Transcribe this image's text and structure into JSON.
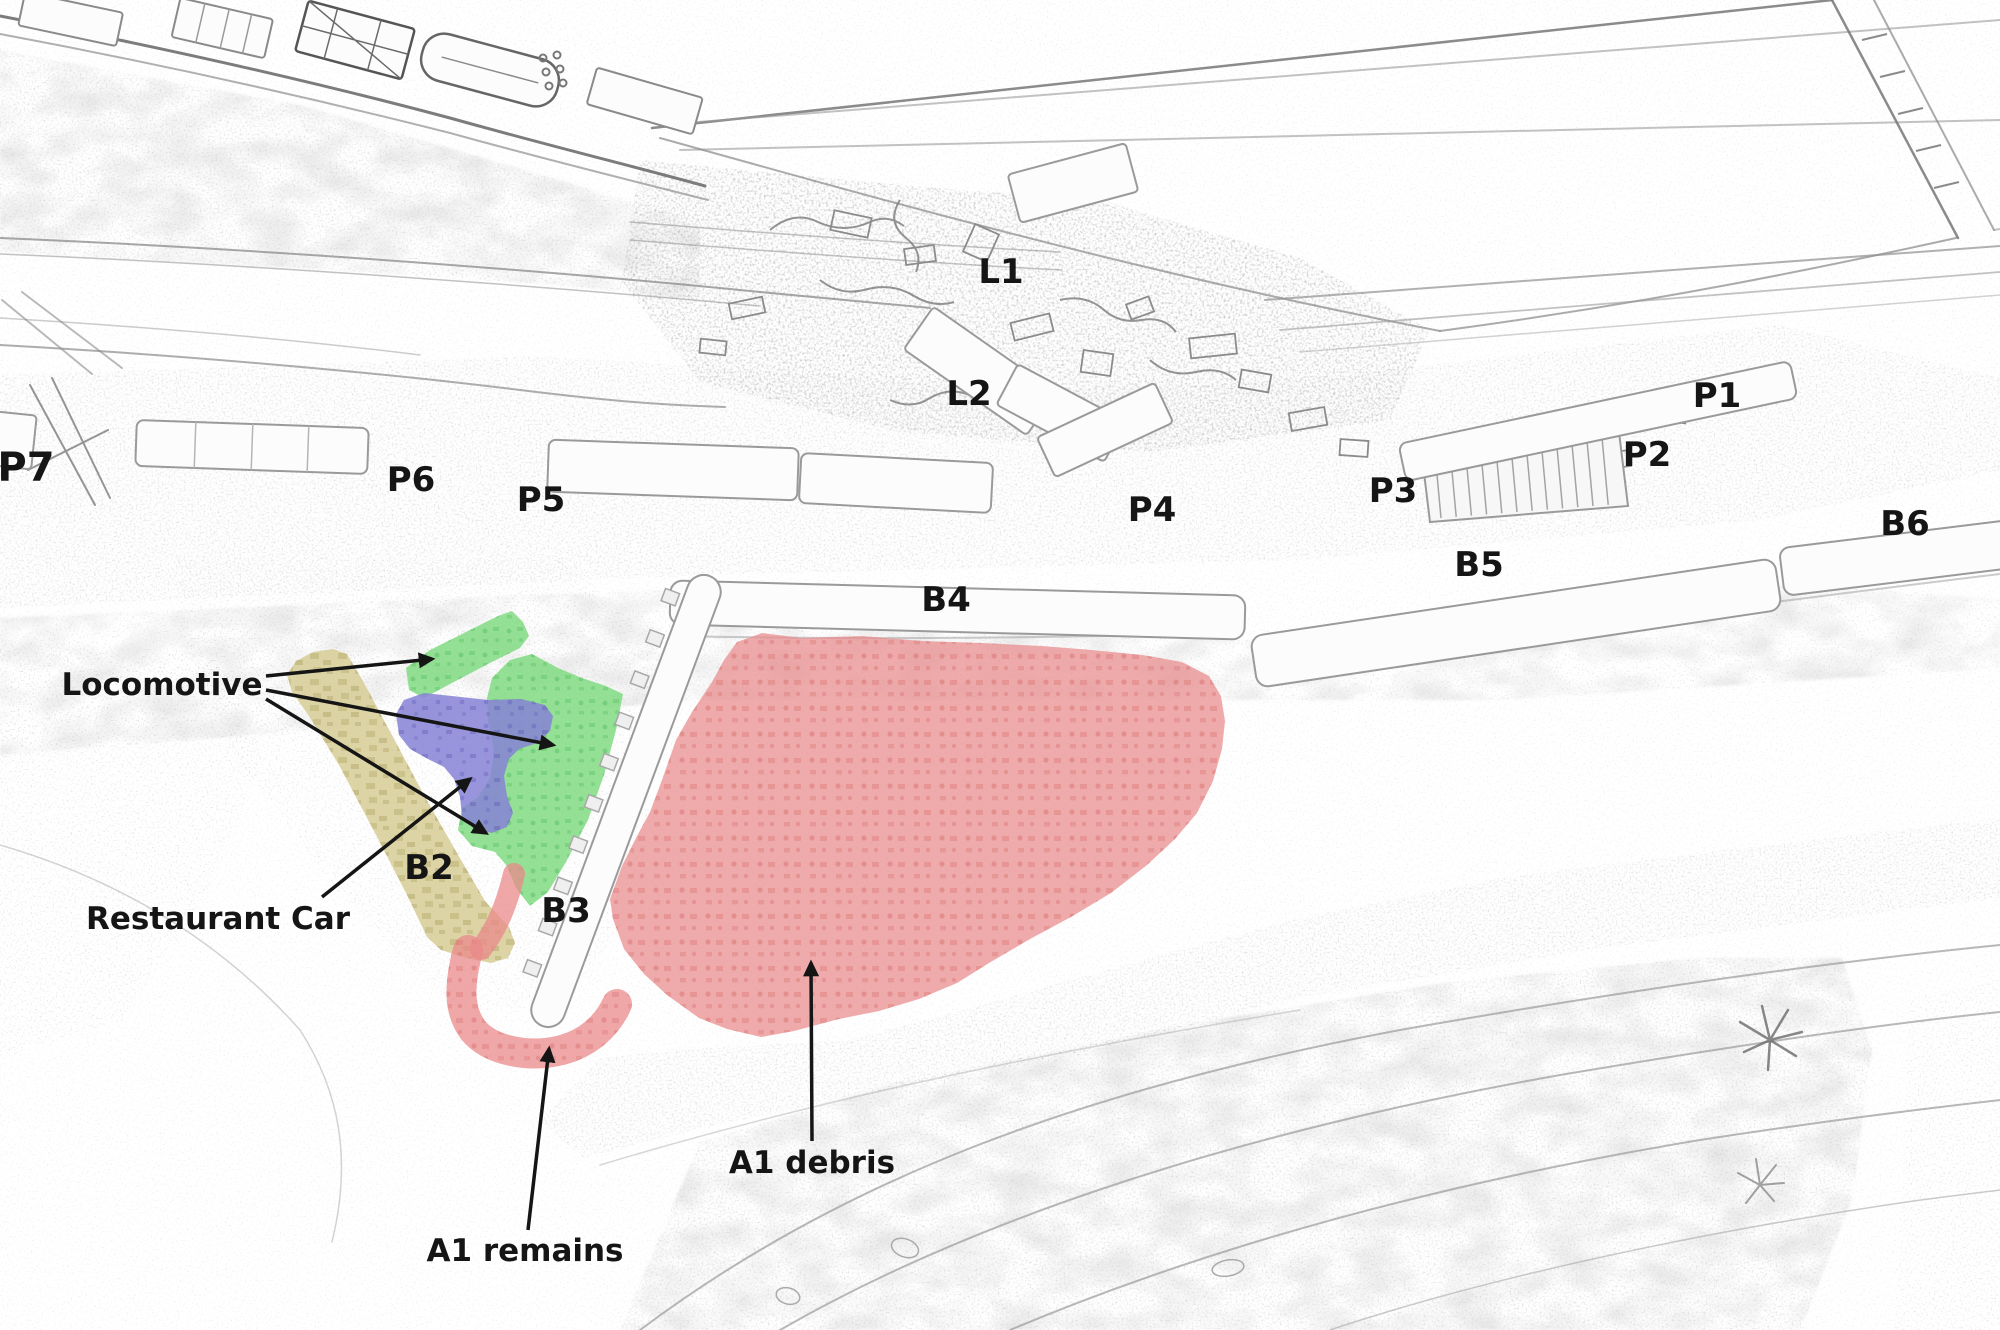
{
  "diagram": {
    "title": "Derailment site sketch map",
    "canvas": {
      "width": 2000,
      "height": 1330
    },
    "colors": {
      "background": "#ffffff",
      "sketch_line": "#8f8f8f",
      "label_text": "#151515",
      "arrow": "#151515",
      "car_fill": "#fcfcfc",
      "locomotive_green": "#79da7c",
      "restaurant_car_blue": "#8783d6",
      "carriage_tan": "#d7cc97",
      "wreck_red": "#e98a8a"
    },
    "car_labels": [
      {
        "id": "P7",
        "text": "P7",
        "x": 26,
        "y": 466,
        "size": 40
      },
      {
        "id": "P6",
        "text": "P6",
        "x": 411,
        "y": 479,
        "size": 34
      },
      {
        "id": "P5",
        "text": "P5",
        "x": 541,
        "y": 499,
        "size": 34
      },
      {
        "id": "L1",
        "text": "L1",
        "x": 1001,
        "y": 271,
        "size": 34
      },
      {
        "id": "L2",
        "text": "L2",
        "x": 969,
        "y": 393,
        "size": 34
      },
      {
        "id": "P4",
        "text": "P4",
        "x": 1152,
        "y": 509,
        "size": 34
      },
      {
        "id": "P3",
        "text": "P3",
        "x": 1393,
        "y": 490,
        "size": 34
      },
      {
        "id": "P2",
        "text": "P2",
        "x": 1647,
        "y": 454,
        "size": 34
      },
      {
        "id": "P1",
        "text": "P1",
        "x": 1717,
        "y": 395,
        "size": 34
      },
      {
        "id": "B6",
        "text": "B6",
        "x": 1905,
        "y": 523,
        "size": 34
      },
      {
        "id": "B5",
        "text": "B5",
        "x": 1479,
        "y": 564,
        "size": 34
      },
      {
        "id": "B4",
        "text": "B4",
        "x": 946,
        "y": 599,
        "size": 34
      },
      {
        "id": "B3",
        "text": "B3",
        "x": 566,
        "y": 910,
        "size": 34
      },
      {
        "id": "B2",
        "text": "B2",
        "x": 429,
        "y": 867,
        "size": 34
      }
    ],
    "annotations": [
      {
        "id": "locomotive",
        "text": "Locomotive",
        "x": 162,
        "y": 684,
        "arrows": [
          {
            "x1": 266,
            "y1": 676,
            "x2": 432,
            "y2": 659
          },
          {
            "x1": 266,
            "y1": 690,
            "x2": 553,
            "y2": 745
          },
          {
            "x1": 266,
            "y1": 699,
            "x2": 486,
            "y2": 833
          }
        ]
      },
      {
        "id": "restaurant-car",
        "text": "Restaurant Car",
        "x": 218,
        "y": 918,
        "arrows": [
          {
            "x1": 322,
            "y1": 897,
            "x2": 470,
            "y2": 779
          }
        ]
      },
      {
        "id": "a1-remains",
        "text": "A1 remains",
        "x": 525,
        "y": 1250,
        "arrows": [
          {
            "x1": 528,
            "y1": 1230,
            "x2": 549,
            "y2": 1049
          }
        ]
      },
      {
        "id": "a1-debris",
        "text": "A1 debris",
        "x": 812,
        "y": 1162,
        "arrows": [
          {
            "x1": 812,
            "y1": 1141,
            "x2": 811,
            "y2": 963
          }
        ]
      }
    ],
    "regions": [
      {
        "id": "locomotive-area",
        "color_key": "locomotive_green",
        "label_ref": "Locomotive"
      },
      {
        "id": "restaurant-car-area",
        "color_key": "restaurant_car_blue",
        "label_ref": "Restaurant Car"
      },
      {
        "id": "carriage-b2-area",
        "color_key": "carriage_tan",
        "label_ref": "B2"
      },
      {
        "id": "a1-debris-area",
        "color_key": "wreck_red",
        "label_ref": "A1 debris"
      },
      {
        "id": "a1-remains-area",
        "color_key": "wreck_red",
        "label_ref": "A1 remains"
      }
    ]
  }
}
